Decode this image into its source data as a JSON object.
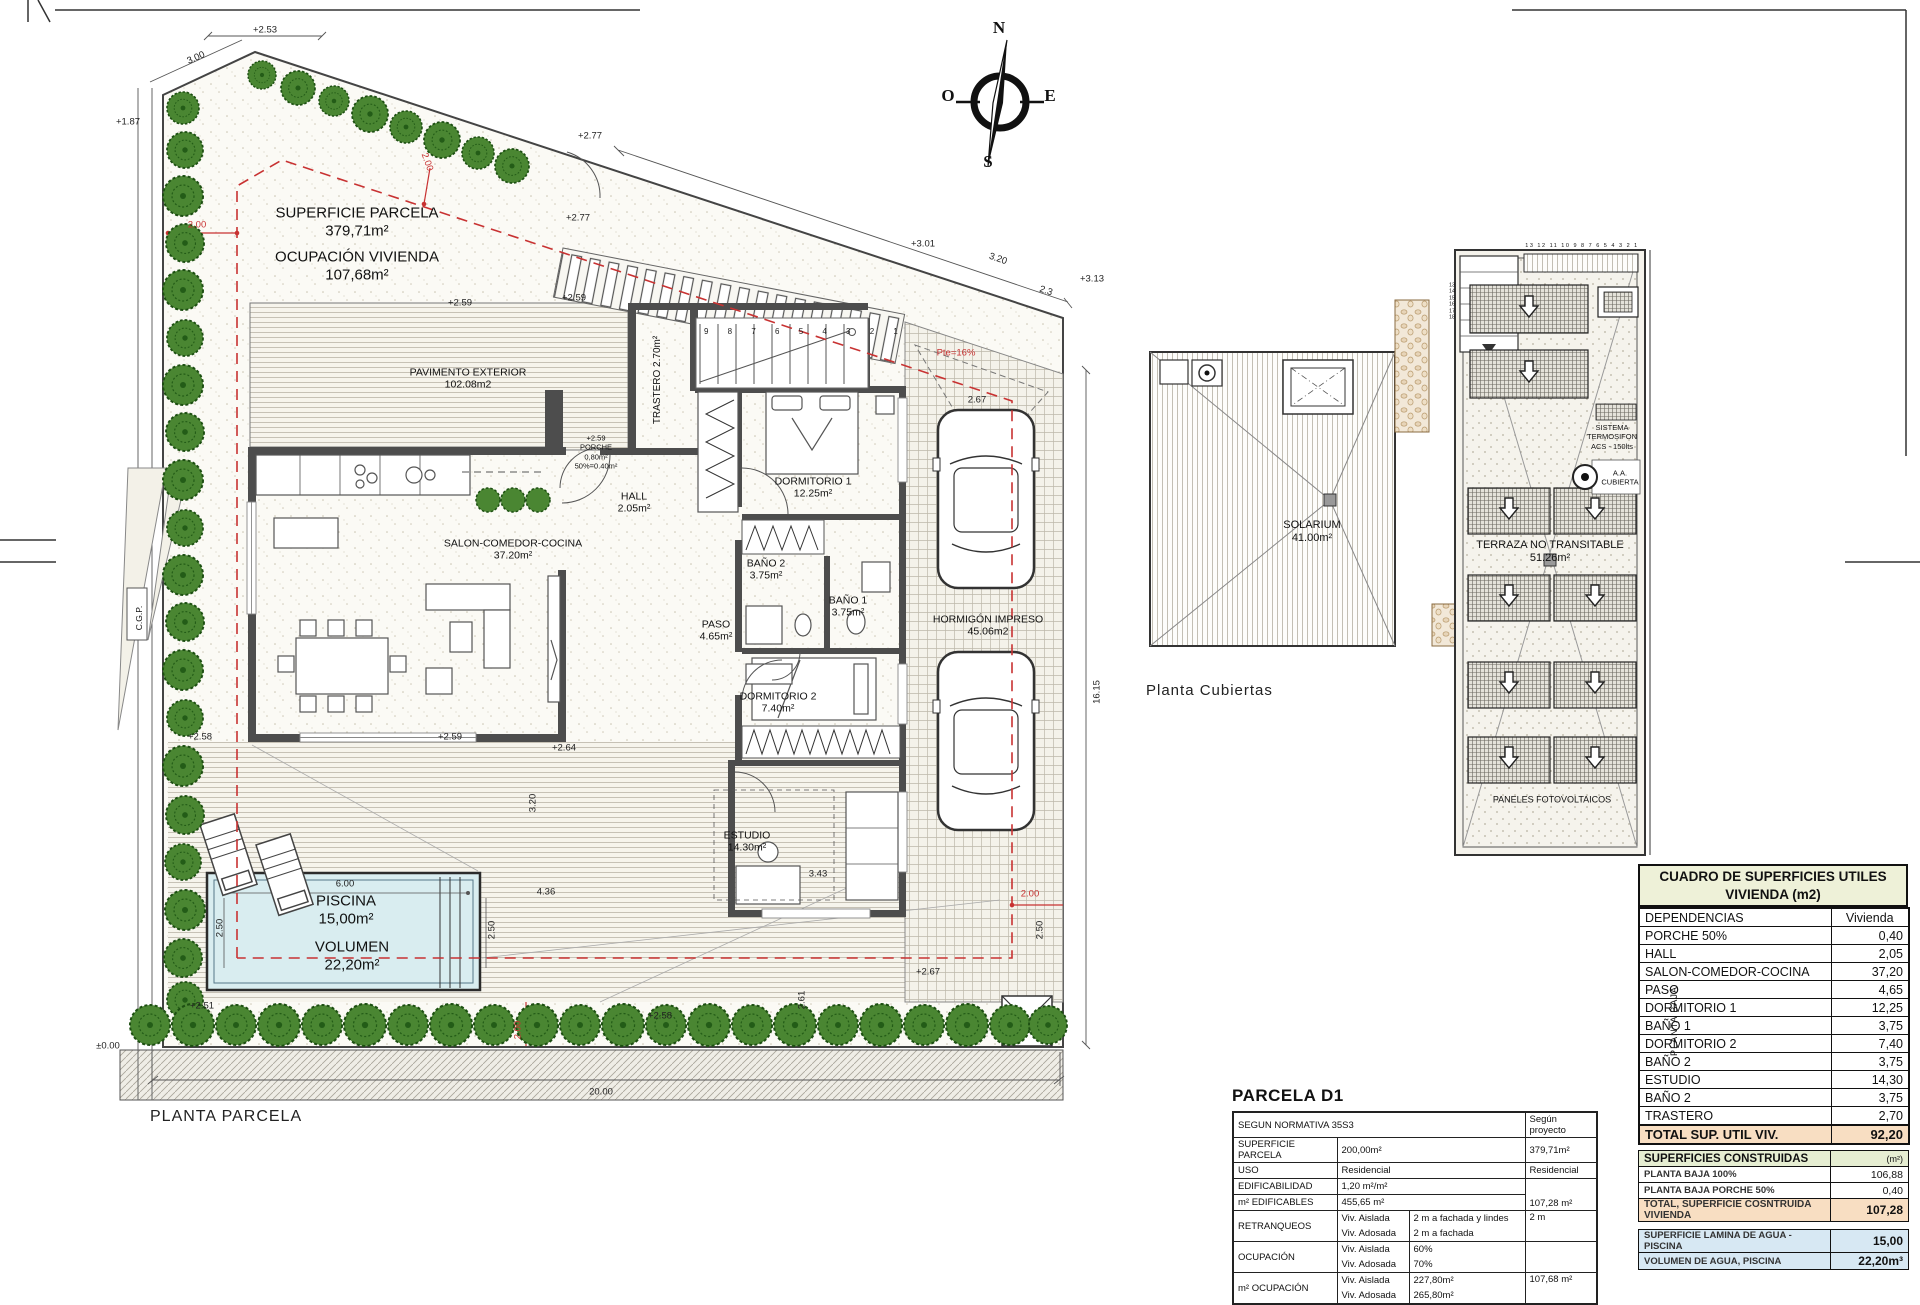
{
  "compass": {
    "n": "N",
    "s": "S",
    "e": "E",
    "o": "O"
  },
  "site": {
    "title": "PLANTA PARCELA",
    "cgp": "C.G.P.",
    "notes": {
      "l1": "SUPERFICIE PARCELA",
      "l2": "379,71m²",
      "l3": "OCUPACIÓN VIVIENDA",
      "l4": "107,68m²"
    },
    "rooms": [
      {
        "name": "PAVIMENTO EXTERIOR",
        "area": "102.08m2"
      },
      {
        "name": "HALL",
        "area": "2.05m²"
      },
      {
        "name": "SALON-COMEDOR-COCINA",
        "area": "37.20m²"
      },
      {
        "name": "TRASTERO",
        "area": "2.70m²"
      },
      {
        "name": "DORMITORIO 1",
        "area": "12.25m²"
      },
      {
        "name": "BAÑO 2",
        "area": "3.75m²"
      },
      {
        "name": "BAÑO 1",
        "area": "3.75m²"
      },
      {
        "name": "PASO",
        "area": "4.65m²"
      },
      {
        "name": "DORMITORIO 2",
        "area": "7.40m²"
      },
      {
        "name": "ESTUDIO",
        "area": "14.30m²"
      },
      {
        "name": "HORMIGÓN IMPRESO",
        "area": "45.06m2"
      }
    ],
    "porch": {
      "l1": "+2.59",
      "l2": "PORCHE",
      "l3": "0,80m²",
      "l4": "50%=0.40m²"
    },
    "pool": {
      "name": "PISCINA",
      "area": "15,00m²",
      "vol_label": "VOLUMEN",
      "vol": "22,20m²"
    },
    "stair_numbers": "9 8 7 6 5 4 3 2 1",
    "dims": [
      "+2.53",
      "3.00",
      "+1.87",
      "2.00",
      "2.00",
      "+2.77",
      "+2.77",
      "+3.01",
      "3.20",
      "+3.13",
      "2.3",
      "Pte=16%",
      "2.67",
      "+2.59",
      "+2.59",
      "+2.58",
      "+2.59",
      "+2.64",
      "16.15",
      "20.00",
      "±0.00",
      "+2.51",
      "+2.58",
      "+2.67",
      "2.00",
      "3.43",
      "2.61",
      "4.36",
      "3.20",
      "6.00",
      "2.50",
      "2.50",
      "2.00",
      "2.50"
    ]
  },
  "roof": {
    "title": "Planta Cubiertas",
    "solarium": {
      "name": "SOLARIUM",
      "area": "41.00m²"
    },
    "terraza": {
      "name": "TERRAZA NO TRANSITABLE",
      "area": "51.26m²"
    },
    "sistema": {
      "l1": "SISTEMA",
      "l2": "TERMOSIFON",
      "l3": "ACS - 150lts"
    },
    "aa": {
      "l1": "A.A.",
      "l2": "CUBIERTA"
    },
    "paneles": "PANELES FOTOVOLTAICOS",
    "top_numbers": "13 12 11 10 9 8 7 6 5 4 3 2 1",
    "stair_numbers": "13\n14\n15\n16\n17\n18"
  },
  "parcela_table": {
    "title": "PARCELA D1",
    "header": {
      "norm": "SEGUN NORMATIVA 35S3",
      "proj": "Según proyecto"
    },
    "rows": {
      "superficie": {
        "label": "SUPERFICIE PARCELA",
        "norm": "200,00m²",
        "proj": "379,71m²"
      },
      "uso": {
        "label": "USO",
        "norm": "Residencial",
        "proj": "Residencial"
      },
      "edificabilidad": {
        "label": "EDIFICABILIDAD",
        "norm": "1,20 m²/m²"
      },
      "edificables": {
        "label": "m² EDIFICABLES",
        "norm": "455,65 m²",
        "proj": "107,28 m²"
      },
      "retranqueos": {
        "label": "RETRANQUEOS",
        "k1": "Viv. Aislada",
        "v1": "2 m a fachada y lindes",
        "k2": "Viv. Adosada",
        "v2": "2 m a fachada",
        "proj": "2 m"
      },
      "ocupacion": {
        "label": "OCUPACIÓN",
        "k1": "Viv. Aislada",
        "v1": "60%",
        "k2": "Viv. Adosada",
        "v2": "70%",
        "proj": ""
      },
      "m2ocupacion": {
        "label": "m² OCUPACIÓN",
        "k1": "Viv. Aislada",
        "v1": "227,80m²",
        "k2": "Viv. Adosada",
        "v2": "265,80m²",
        "proj": "107,68 m²"
      }
    }
  },
  "cuadro": {
    "title1": "CUADRO DE SUPERFICIES UTILES",
    "title2": "VIVIENDA (m2)",
    "col_dep": "DEPENDENCIAS",
    "col_viv": "Vivienda",
    "side": "PLANTA BAJA",
    "rows": [
      {
        "d": "PORCHE 50%",
        "v": "0,40"
      },
      {
        "d": "HALL",
        "v": "2,05"
      },
      {
        "d": "SALON-COMEDOR-COCINA",
        "v": "37,20"
      },
      {
        "d": "PASO",
        "v": "4,65"
      },
      {
        "d": "DORMITORIO 1",
        "v": "12,25"
      },
      {
        "d": "BAÑO 1",
        "v": "3,75"
      },
      {
        "d": "DORMITORIO 2",
        "v": "7,40"
      },
      {
        "d": "BAÑO 2",
        "v": "3,75"
      },
      {
        "d": "ESTUDIO",
        "v": "14,30"
      },
      {
        "d": "BAÑO 2",
        "v": "3,75"
      },
      {
        "d": "TRASTERO",
        "v": "2,70"
      }
    ],
    "total": {
      "label": "TOTAL SUP. UTIL VIV.",
      "value": "92,20"
    },
    "constructed": {
      "header": "SUPERFICIES CONSTRUIDAS",
      "unit": "(m²)",
      "rows": [
        {
          "d": "PLANTA BAJA 100%",
          "v": "106,88"
        },
        {
          "d": "PLANTA BAJA PORCHE 50%",
          "v": "0,40"
        }
      ],
      "total": {
        "label": "TOTAL, SUPERFICIE COSNTRUIDA VIVIENDA",
        "value": "107,28"
      }
    },
    "pool_rows": [
      {
        "d": "SUPERFICIE LAMINA DE AGUA - PISCINA",
        "v": "15,00"
      },
      {
        "d": "VOLUMEN DE AGUA, PISCINA",
        "v": "22,20m³"
      }
    ]
  },
  "colors": {
    "setback_red": "#c83232",
    "pool_blue": "#d9edf0",
    "tree_green": "#4a8632",
    "total_peach": "#f8dec2",
    "section_green": "#e6eed2",
    "title_cream": "#eef1d8",
    "pool_row_blue": "#d7e8f3"
  }
}
